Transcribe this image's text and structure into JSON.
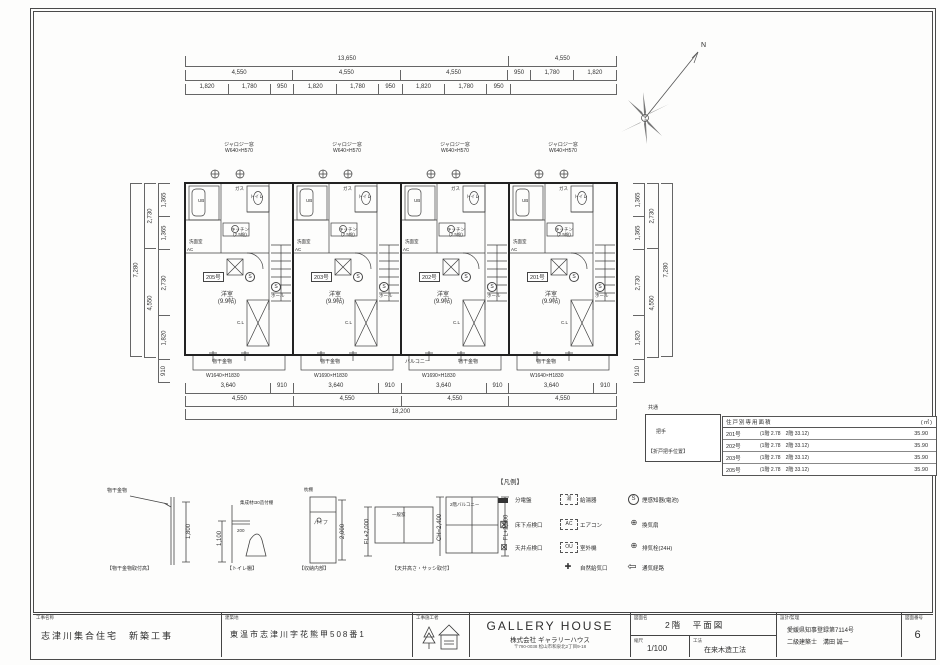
{
  "plan": {
    "common": {
      "room": "洋室",
      "area": "(9.9帖)",
      "kitchen": "キッチン",
      "kitchen_area": "(2.5帖)",
      "wash": "洗面室",
      "hall": "ホール",
      "closet": "C.L",
      "ub": "UB",
      "toilet": "トイレ",
      "gas": "ガス",
      "ac": "AC",
      "detector": "S",
      "window_label": "ジャロジー窓",
      "window_size": "W640×H570",
      "hanger": "物干金物"
    },
    "units": [
      {
        "number": "205号",
        "bottom_window": "W1640×H1830"
      },
      {
        "number": "203号",
        "bottom_window": "W1690×H1830"
      },
      {
        "number": "202号",
        "bottom_window": "W1690×H1830"
      },
      {
        "number": "201号",
        "bottom_window": "W1640×H1830"
      }
    ],
    "balcony_label": "バルコニー"
  },
  "north": {
    "label": "N"
  },
  "dims": {
    "top1": [
      "13,650",
      "4,550"
    ],
    "top2": [
      "4,550",
      "4,550",
      "4,550",
      "950",
      "1,780",
      "1,820"
    ],
    "top3": [
      "1,820",
      "1,780",
      "950",
      "1,820",
      "1,780",
      "950",
      "1,820",
      "1,780",
      "950"
    ],
    "bottom1": [
      "3,640",
      "910",
      "3,640",
      "910",
      "3,640",
      "910",
      "3,640",
      "910"
    ],
    "bottom2": [
      "4,550",
      "4,550",
      "4,550",
      "4,550"
    ],
    "bottom3": "18,200",
    "left_inner": [
      "1,365",
      "1,365",
      "2,730",
      "1,820"
    ],
    "left_mid": [
      "2,730",
      "4,550"
    ],
    "left_outer": "7,280",
    "left_bottom": "910",
    "right_inner": [
      "1,365",
      "1,365",
      "2,730",
      "1,820"
    ],
    "right_mid": [
      "2,730",
      "4,550"
    ],
    "right_outer": "7,280",
    "right_bottom": "910"
  },
  "area_table": {
    "title": "住戸別専用面積",
    "unit_suffix": "(㎡)",
    "rows": [
      {
        "name": "201号",
        "detail": "(1階 2.78　2階 33.12)",
        "total": "35.90"
      },
      {
        "name": "202号",
        "detail": "(1階 2.78　2階 33.12)",
        "total": "35.90"
      },
      {
        "name": "203号",
        "detail": "(1階 2.78　2階 33.12)",
        "total": "35.90"
      },
      {
        "name": "205号",
        "detail": "(1階 2.78　2階 33.12)",
        "total": "35.90"
      }
    ]
  },
  "common_box": {
    "label": "共通",
    "handle": "把手",
    "caption": "【折戸把手位置】"
  },
  "legend": {
    "title": "【凡例】",
    "items": [
      {
        "name": "分電盤",
        "glyph": ""
      },
      {
        "name": "給湯器",
        "glyph": "湯"
      },
      {
        "name": "煙感知器(電池)",
        "glyph": "S"
      },
      {
        "name": "床下点検口",
        "glyph": "⊠"
      },
      {
        "name": "エアコン",
        "glyph": "AC"
      },
      {
        "name": "換気扇",
        "glyph": "⊕"
      },
      {
        "name": "天井点検口",
        "glyph": "⊠"
      },
      {
        "name": "室外機",
        "glyph": "OU"
      },
      {
        "name": "排気栓(24H)",
        "glyph": "⊕"
      },
      {
        "name": "自然給気口",
        "glyph": "✚"
      },
      {
        "name": "通気経路",
        "glyph": "⇦"
      }
    ]
  },
  "details": {
    "d1": {
      "caption": "【物干金物取付高】",
      "label": "物干金物",
      "dim": "1,800"
    },
    "d2": {
      "caption": "【トイレ棚】",
      "note": "集成材t30造付棚",
      "dim1": "1,100",
      "dim2": "200"
    },
    "d3": {
      "caption": "【収納内部】",
      "shelf": "枕棚",
      "pipe": "パイプ",
      "dim": "2,000"
    },
    "d4": {
      "caption": "【天井高さ・サッシ取付】",
      "win1": "一般窓",
      "win2": "2階バルコニー",
      "dim1": "FL+2,000",
      "dim2": "CH=2,400",
      "dim3": "FL+2,000"
    }
  },
  "title_block": {
    "f1_label": "工事名称",
    "f1_value": "志津川集合住宅　新築工事",
    "f2_label": "建築地",
    "f2_value": "東温市志津川字花熊甲508番1",
    "f3_label": "工事施工者",
    "brand": "GALLERY HOUSE",
    "brand_sub": "株式会社 ギャラリーハウス",
    "brand_addr": "〒790-0038 松山市和泉北2丁目9-18",
    "f4_label": "図面名",
    "f4_value": "2階　平面図",
    "f5_label": "縮尺",
    "f5_value": "1/100",
    "f6_label": "工法",
    "f6_value": "在来木造工法",
    "f7_label": "設計/監理",
    "f7_line1": "愛媛県知事登録第7114号",
    "f7_line2": "二級建築士　溝田 誠一",
    "f8_label": "図面番号",
    "f8_value": "6"
  }
}
